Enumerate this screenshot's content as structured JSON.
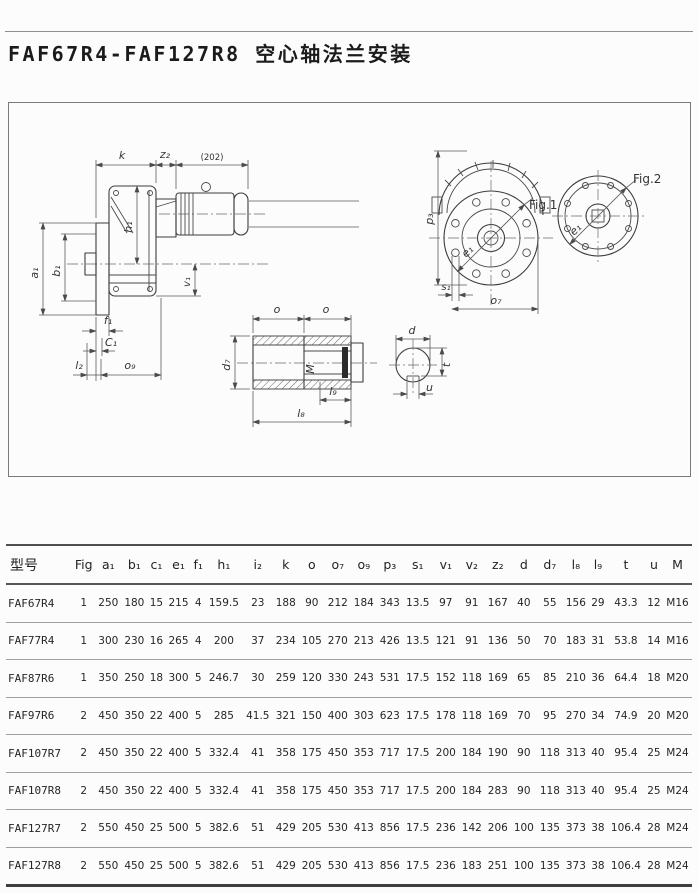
{
  "page": {
    "title": "FAF67R4-FAF127R8 空心轴法兰安装"
  },
  "drawing": {
    "labels": {
      "k": "k",
      "z2": "z₂",
      "br202": "(202)",
      "a1": "a₁",
      "b1": "b₁",
      "h1": "h₁",
      "v1": "v₁",
      "f1": "f₁",
      "c1": "C₁",
      "l2": "l₂",
      "o9": "o₉",
      "p3": "p₃",
      "e1": "e₁",
      "fig1": "Fig.1",
      "fig2": "Fig.2",
      "s1": "s₁",
      "o7": "o₇",
      "o": "o",
      "d7": "d₇",
      "m": "M",
      "l9": "l₉",
      "l8": "l₈",
      "d": "d",
      "t": "t",
      "u": "u"
    }
  },
  "table": {
    "columns": [
      "型号",
      "Fig",
      "a₁",
      "b₁",
      "c₁",
      "e₁",
      "f₁",
      "h₁",
      "i₂",
      "k",
      "o",
      "o₇",
      "o₉",
      "p₃",
      "s₁",
      "v₁",
      "v₂",
      "z₂",
      "d",
      "d₇",
      "l₈",
      "l₉",
      "t",
      "u",
      "M"
    ],
    "rows": [
      [
        "FAF67R4",
        "1",
        "250",
        "180",
        "15",
        "215",
        "4",
        "159.5",
        "23",
        "188",
        "90",
        "212",
        "184",
        "343",
        "13.5",
        "97",
        "91",
        "167",
        "40",
        "55",
        "156",
        "29",
        "43.3",
        "12",
        "M16"
      ],
      [
        "FAF77R4",
        "1",
        "300",
        "230",
        "16",
        "265",
        "4",
        "200",
        "37",
        "234",
        "105",
        "270",
        "213",
        "426",
        "13.5",
        "121",
        "91",
        "136",
        "50",
        "70",
        "183",
        "31",
        "53.8",
        "14",
        "M16"
      ],
      [
        "FAF87R6",
        "1",
        "350",
        "250",
        "18",
        "300",
        "5",
        "246.7",
        "30",
        "259",
        "120",
        "330",
        "243",
        "531",
        "17.5",
        "152",
        "118",
        "169",
        "65",
        "85",
        "210",
        "36",
        "64.4",
        "18",
        "M20"
      ],
      [
        "FAF97R6",
        "2",
        "450",
        "350",
        "22",
        "400",
        "5",
        "285",
        "41.5",
        "321",
        "150",
        "400",
        "303",
        "623",
        "17.5",
        "178",
        "118",
        "169",
        "70",
        "95",
        "270",
        "34",
        "74.9",
        "20",
        "M20"
      ],
      [
        "FAF107R7",
        "2",
        "450",
        "350",
        "22",
        "400",
        "5",
        "332.4",
        "41",
        "358",
        "175",
        "450",
        "353",
        "717",
        "17.5",
        "200",
        "184",
        "190",
        "90",
        "118",
        "313",
        "40",
        "95.4",
        "25",
        "M24"
      ],
      [
        "FAF107R8",
        "2",
        "450",
        "350",
        "22",
        "400",
        "5",
        "332.4",
        "41",
        "358",
        "175",
        "450",
        "353",
        "717",
        "17.5",
        "200",
        "184",
        "283",
        "90",
        "118",
        "313",
        "40",
        "95.4",
        "25",
        "M24"
      ],
      [
        "FAF127R7",
        "2",
        "550",
        "450",
        "25",
        "500",
        "5",
        "382.6",
        "51",
        "429",
        "205",
        "530",
        "413",
        "856",
        "17.5",
        "236",
        "142",
        "206",
        "100",
        "135",
        "373",
        "38",
        "106.4",
        "28",
        "M24"
      ],
      [
        "FAF127R8",
        "2",
        "550",
        "450",
        "25",
        "500",
        "5",
        "382.6",
        "51",
        "429",
        "205",
        "530",
        "413",
        "856",
        "17.5",
        "236",
        "183",
        "251",
        "100",
        "135",
        "373",
        "38",
        "106.4",
        "28",
        "M24"
      ]
    ]
  }
}
